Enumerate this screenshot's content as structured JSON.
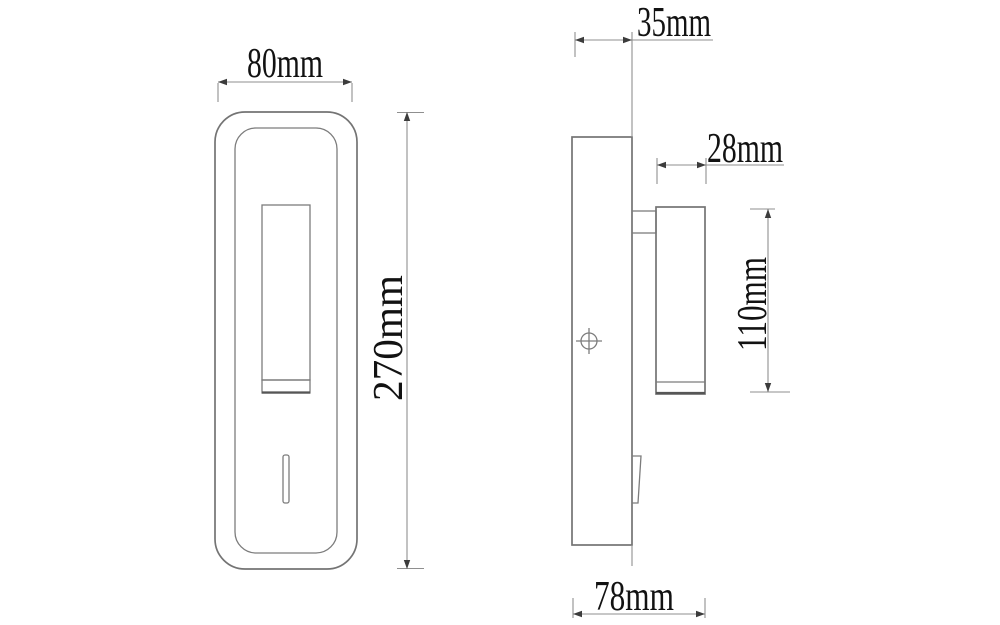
{
  "drawing": {
    "front_view": {
      "dim_width": "80mm",
      "dim_height": "270mm"
    },
    "side_view": {
      "dim_plate_depth": "35mm",
      "dim_head_diameter": "28mm",
      "dim_head_length": "110mm",
      "dim_overall_depth": "78mm"
    },
    "colors": {
      "background": "#ffffff",
      "object_line": "#747474",
      "dimension_line": "#8f8f8f",
      "text": "#121212"
    }
  }
}
